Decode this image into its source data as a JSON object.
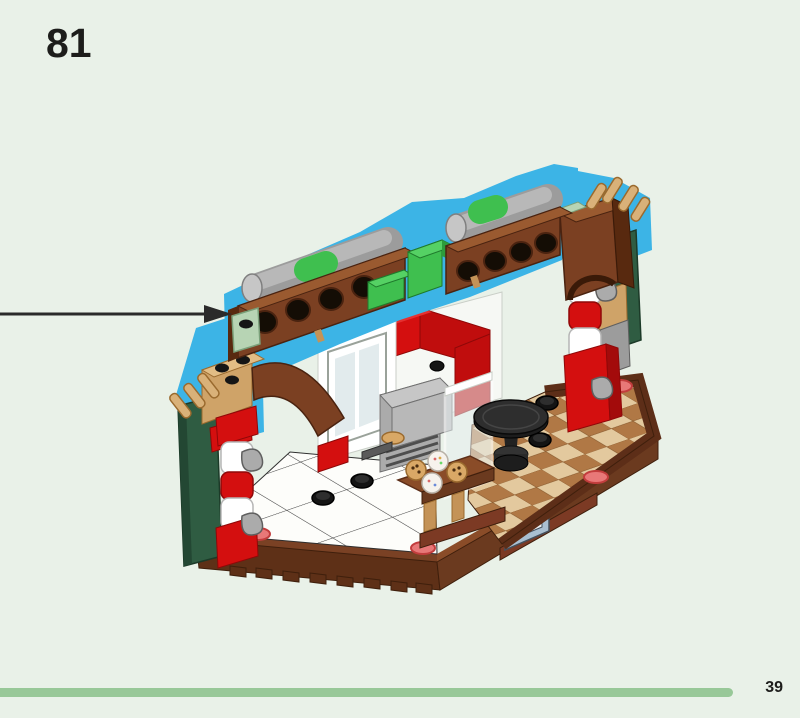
{
  "page": {
    "step_number": "81",
    "page_number": "39"
  },
  "progress": {
    "fraction_complete": 0.916
  },
  "palette": {
    "background": "#e9f1e8",
    "progress-bar": "#98c898",
    "text": "#1d1d1b",
    "highlight": "#3cb4e6",
    "arrow": "#2a2a2a"
  },
  "illustration": {
    "subject": "lego-assembly-step",
    "callout_arrow_direction": "right",
    "highlight_color": "#3cb4e6",
    "part_colors": {
      "reddish_brown": "#7b4022",
      "dark_brown_base": "#5e3017",
      "bright_green": "#3fbf4f",
      "sage_green": "#b7d4b4",
      "dark_green_panel": "#2f5c42",
      "red": "#d40f0f",
      "white": "#ffffff",
      "tan": "#d9b179",
      "grey": "#9c9c9c",
      "floor_light_tan": "#e3c99e",
      "floor_medium_brown": "#b07845",
      "sand_blue": "#a9bfd1",
      "accent_pink": "#e87878",
      "black": "#151515"
    }
  }
}
